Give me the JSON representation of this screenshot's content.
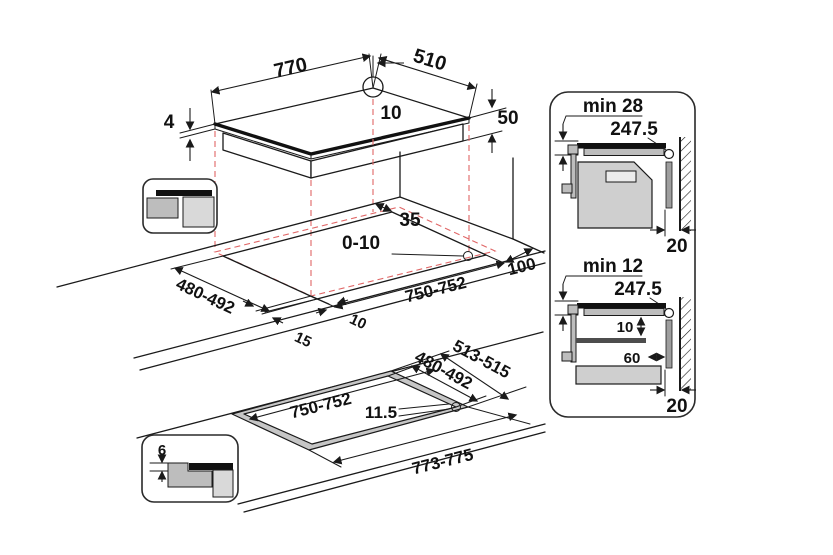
{
  "diagram_type": "cooktop installation dimensions drawing",
  "colors": {
    "line": "#1a1a1a",
    "projection_dashes": "#e06666",
    "glass": "#111111",
    "gray_light": "#d9d9d9",
    "gray_mid": "#bdbdbd",
    "gray_dark": "#9e9e9e",
    "background": "#ffffff"
  },
  "top_view": {
    "width": "770",
    "depth": "510",
    "hole_offset": "10",
    "glass_thickness": "4",
    "body_height": "50"
  },
  "cutout_view": {
    "rear_clearance": "35",
    "edge_gap": "0-10",
    "depth": "480-492",
    "front_overhang": "15",
    "side_overhang": "10",
    "width": "750-752",
    "wall_clearance": "100"
  },
  "flush_view": {
    "outer_depth": "513-515",
    "inner_depth": "480-492",
    "inner_width": "750-752",
    "corner_radius": "11.5",
    "outer_width": "773-775"
  },
  "flush_detail": {
    "recess_depth": "6"
  },
  "clearances": {
    "oven": {
      "min_distance": "min 28",
      "half_width": "247.5",
      "wall_gap": "20"
    },
    "drawer": {
      "min_distance": "min 12",
      "half_width": "247.5",
      "bottom_gap": "10",
      "depth_clearance": "60",
      "wall_gap": "20"
    }
  }
}
